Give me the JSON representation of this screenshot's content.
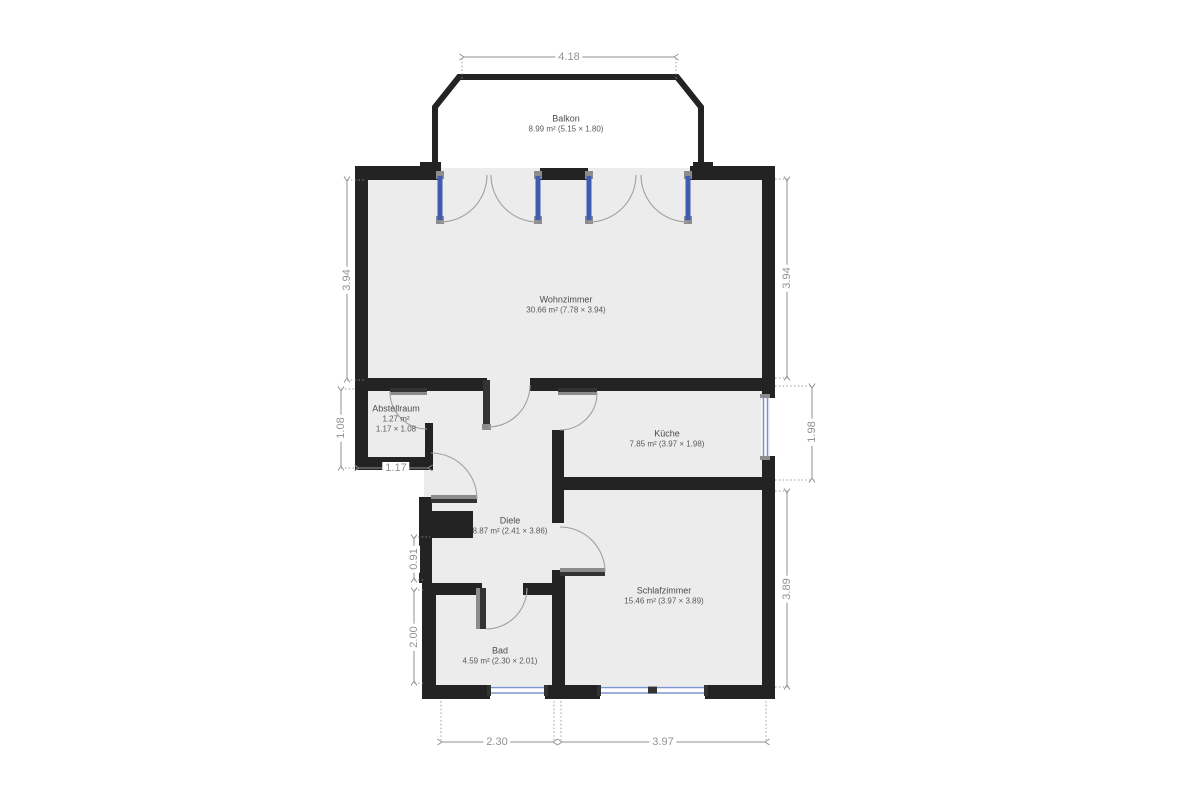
{
  "title": "Floor plan",
  "colors": {
    "wall": "#232323",
    "room_fill": "#ececec",
    "balcony_fill": "#ffffff",
    "dim": "#929292",
    "arc": "#a0a0a0",
    "door_blue": "#3f5cb0",
    "window_blue": "#7b96cf",
    "jamb": "#8c8c8c",
    "leaf": "#333333",
    "label": "#4d4d4d"
  },
  "rooms": [
    {
      "id": "balkon",
      "name": "Balkon",
      "area": "8.99 m² (5.15 × 1.80)"
    },
    {
      "id": "wohnzimmer",
      "name": "Wohnzimmer",
      "area": "30.66 m² (7.78 × 3.94)"
    },
    {
      "id": "abstellraum",
      "name": "Abstellraum",
      "area": "1.27 m²",
      "dims": "1.17 × 1.08"
    },
    {
      "id": "kueche",
      "name": "Küche",
      "area": "7.85 m² (3.97 × 1.98)"
    },
    {
      "id": "diele",
      "name": "Diele",
      "area": "8.87 m² (2.41 × 3.86)"
    },
    {
      "id": "schlafzimmer",
      "name": "Schlafzimmer",
      "area": "15.46 m² (3.97 × 3.89)"
    },
    {
      "id": "bad",
      "name": "Bad",
      "area": "4.59 m² (2.30 × 2.01)"
    }
  ],
  "dimensions": {
    "top_width": "4.18",
    "left_upper": "3.94",
    "left_abstellraum": "1.08",
    "abstellraum_width": "1.17",
    "left_shaft": "0.91",
    "left_bad": "2.00",
    "right_upper": "3.94",
    "right_kueche": "1.98",
    "right_schlafzimmer": "3.89",
    "bottom_bad": "2.30",
    "bottom_schlafzimmer": "3.97"
  }
}
